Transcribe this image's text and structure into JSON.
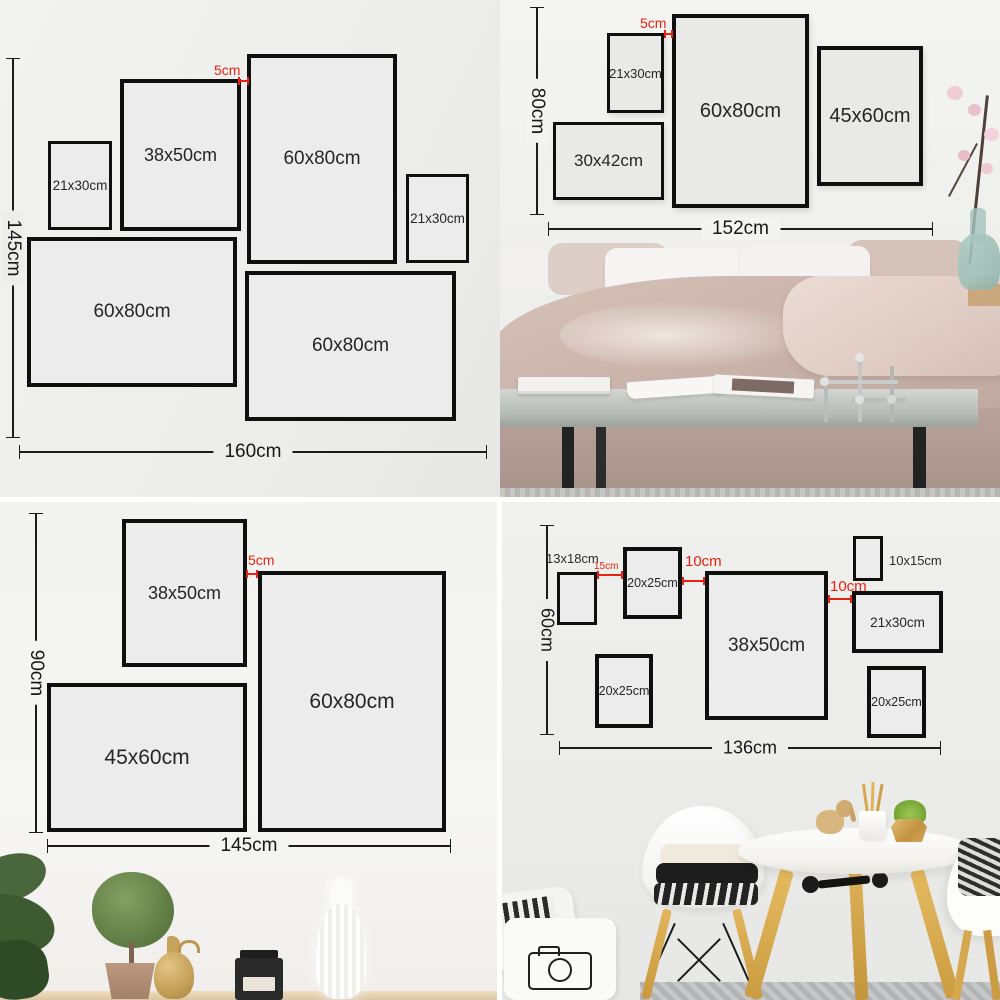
{
  "colors": {
    "accent_red": "#ea2310",
    "frame_border": "#0f0f0f",
    "frame_fill": "#ebeceb",
    "dimension_line": "#1c1c1c"
  },
  "quadrants": {
    "top_left": {
      "height_label": "145cm",
      "width_label": "160cm",
      "gap_label": "5cm",
      "frames": [
        {
          "label": "21x30cm"
        },
        {
          "label": "38x50cm"
        },
        {
          "label": "60x80cm"
        },
        {
          "label": "21x30cm"
        },
        {
          "label": "60x80cm"
        },
        {
          "label": "60x80cm"
        }
      ]
    },
    "top_right": {
      "height_label": "80cm",
      "width_label": "152cm",
      "gap_label": "5cm",
      "frames": [
        {
          "label": "21x30cm"
        },
        {
          "label": "60x80cm"
        },
        {
          "label": "45x60cm"
        },
        {
          "label": "30x42cm"
        }
      ]
    },
    "bottom_left": {
      "height_label": "90cm",
      "width_label": "145cm",
      "gap_label": "5cm",
      "frames": [
        {
          "label": "38x50cm"
        },
        {
          "label": "60x80cm"
        },
        {
          "label": "45x60cm"
        }
      ]
    },
    "bottom_right": {
      "height_label": "60cm",
      "width_label": "136cm",
      "gap_labels": [
        "15cm",
        "10cm",
        "10cm"
      ],
      "frames": [
        {
          "label": "13x18cm"
        },
        {
          "label": "20x25cm"
        },
        {
          "label": "38x50cm"
        },
        {
          "label": "10x15cm"
        },
        {
          "label": "21x30cm"
        },
        {
          "label": "20x25cm"
        },
        {
          "label": "20x25cm"
        }
      ]
    }
  }
}
